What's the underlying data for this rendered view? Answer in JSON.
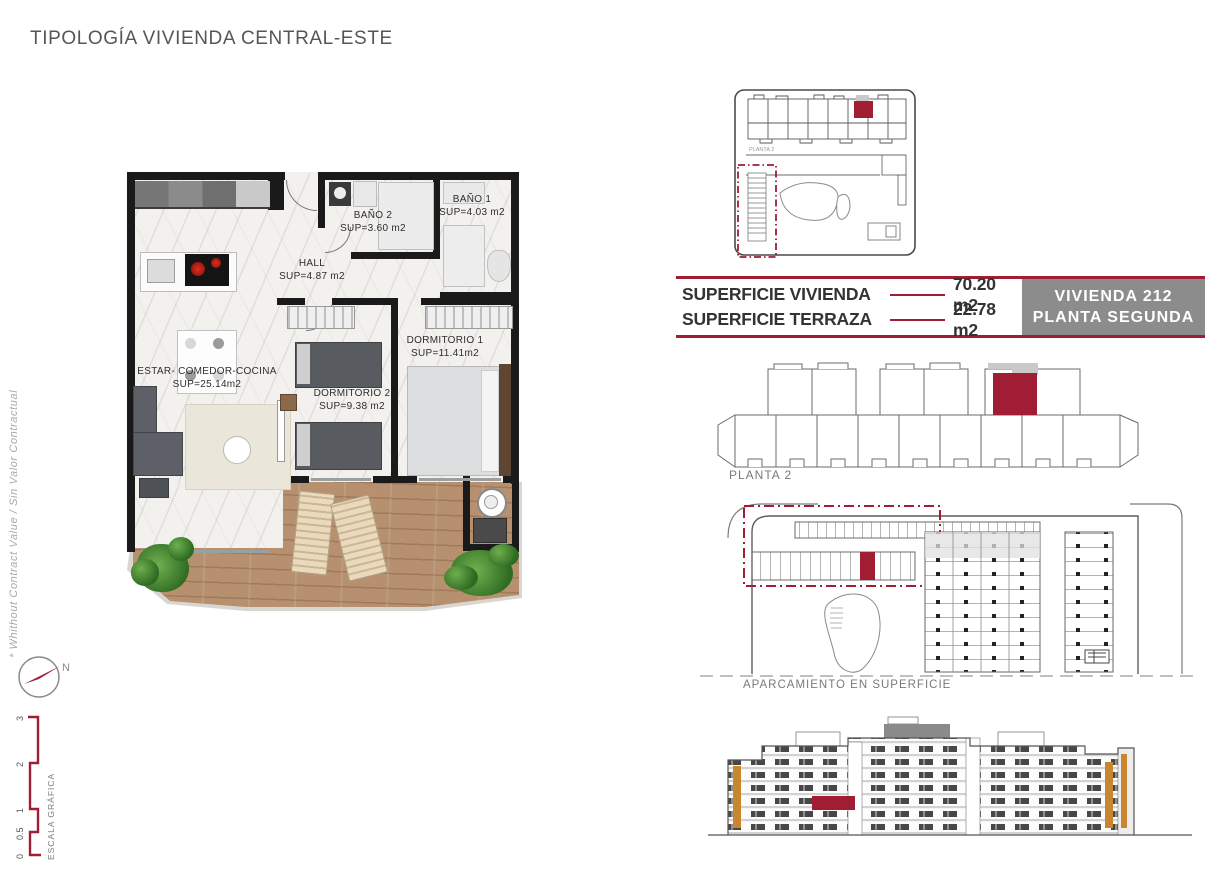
{
  "colors": {
    "accent": "#A01D33",
    "panel_gray": "#8C8C8C",
    "wood": "#B6906F",
    "wall": "#1A1A1A",
    "orange_accent": "#C8872E"
  },
  "title": "TIPOLOGÍA VIVIENDA CENTRAL-ESTE",
  "watermark": "* Whithout Contract Value / Sin Valor Contractual",
  "floor_plan": {
    "rooms": [
      {
        "name": "ESTAR- COMEDOR-COCINA",
        "area": "SUP=25.14m2"
      },
      {
        "name": "HALL",
        "area": "SUP=4.87 m2"
      },
      {
        "name": "BAÑO 2",
        "area": "SUP=3.60 m2"
      },
      {
        "name": "BAÑO 1",
        "area": "SUP=4.03 m2"
      },
      {
        "name": "DORMITORIO 1",
        "area": "SUP=11.41m2"
      },
      {
        "name": "DORMITORIO 2",
        "area": "SUP=9.38 m2"
      }
    ]
  },
  "site_plan": {
    "label": "PLANTA 2"
  },
  "info_table": {
    "rows": [
      {
        "label": "SUPERFICIE VIVIENDA",
        "value": "70.20 m2"
      },
      {
        "label": "SUPERFICIE TERRAZA",
        "value": "22.78 m2"
      }
    ],
    "unit": "VIVIENDA 212",
    "floor": "PLANTA SEGUNDA"
  },
  "floor_overview": {
    "label": "PLANTA 2"
  },
  "parking": {
    "label": "APARCAMIENTO EN SUPERFICIE"
  },
  "compass": {
    "label": "N"
  },
  "scale_bar": {
    "title": "ESCALA GRÁFICA",
    "ticks": [
      "0",
      "0.5",
      "1",
      "2",
      "3"
    ]
  }
}
